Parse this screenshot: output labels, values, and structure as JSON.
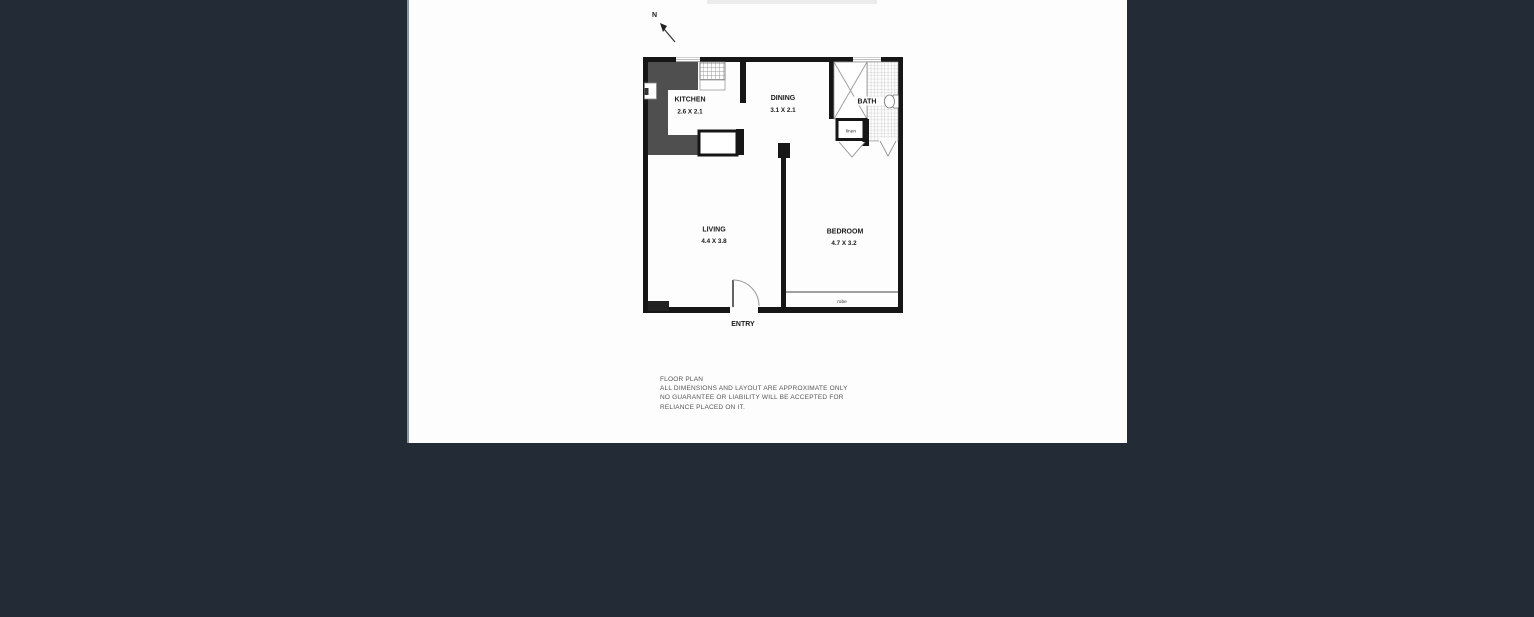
{
  "page": {
    "background_color": "#232b36",
    "paper_color": "#fdfdfd"
  },
  "floor_plan": {
    "north_label": "N",
    "rooms": {
      "kitchen": {
        "name": "KITCHEN",
        "dims": "2.6 X 2.1"
      },
      "dining": {
        "name": "DINING",
        "dims": "3.1 X 2.1"
      },
      "bath": {
        "name": "BATH"
      },
      "living": {
        "name": "LIVING",
        "dims": "4.4 X 3.8"
      },
      "bedroom": {
        "name": "BEDROOM",
        "dims": "4.7 X 3.2"
      }
    },
    "features": {
      "linen": "linen",
      "robe": "robe",
      "entry": "ENTRY"
    },
    "colors": {
      "wall": "#161616",
      "counter": "#4f4f4f"
    }
  },
  "disclaimer": {
    "lines": [
      "FLOOR PLAN",
      "ALL DIMENSIONS AND LAYOUT ARE APPROXIMATE ONLY",
      "NO GUARANTEE OR LIABILITY WILL BE ACCEPTED FOR",
      "RELIANCE PLACED ON IT."
    ]
  }
}
